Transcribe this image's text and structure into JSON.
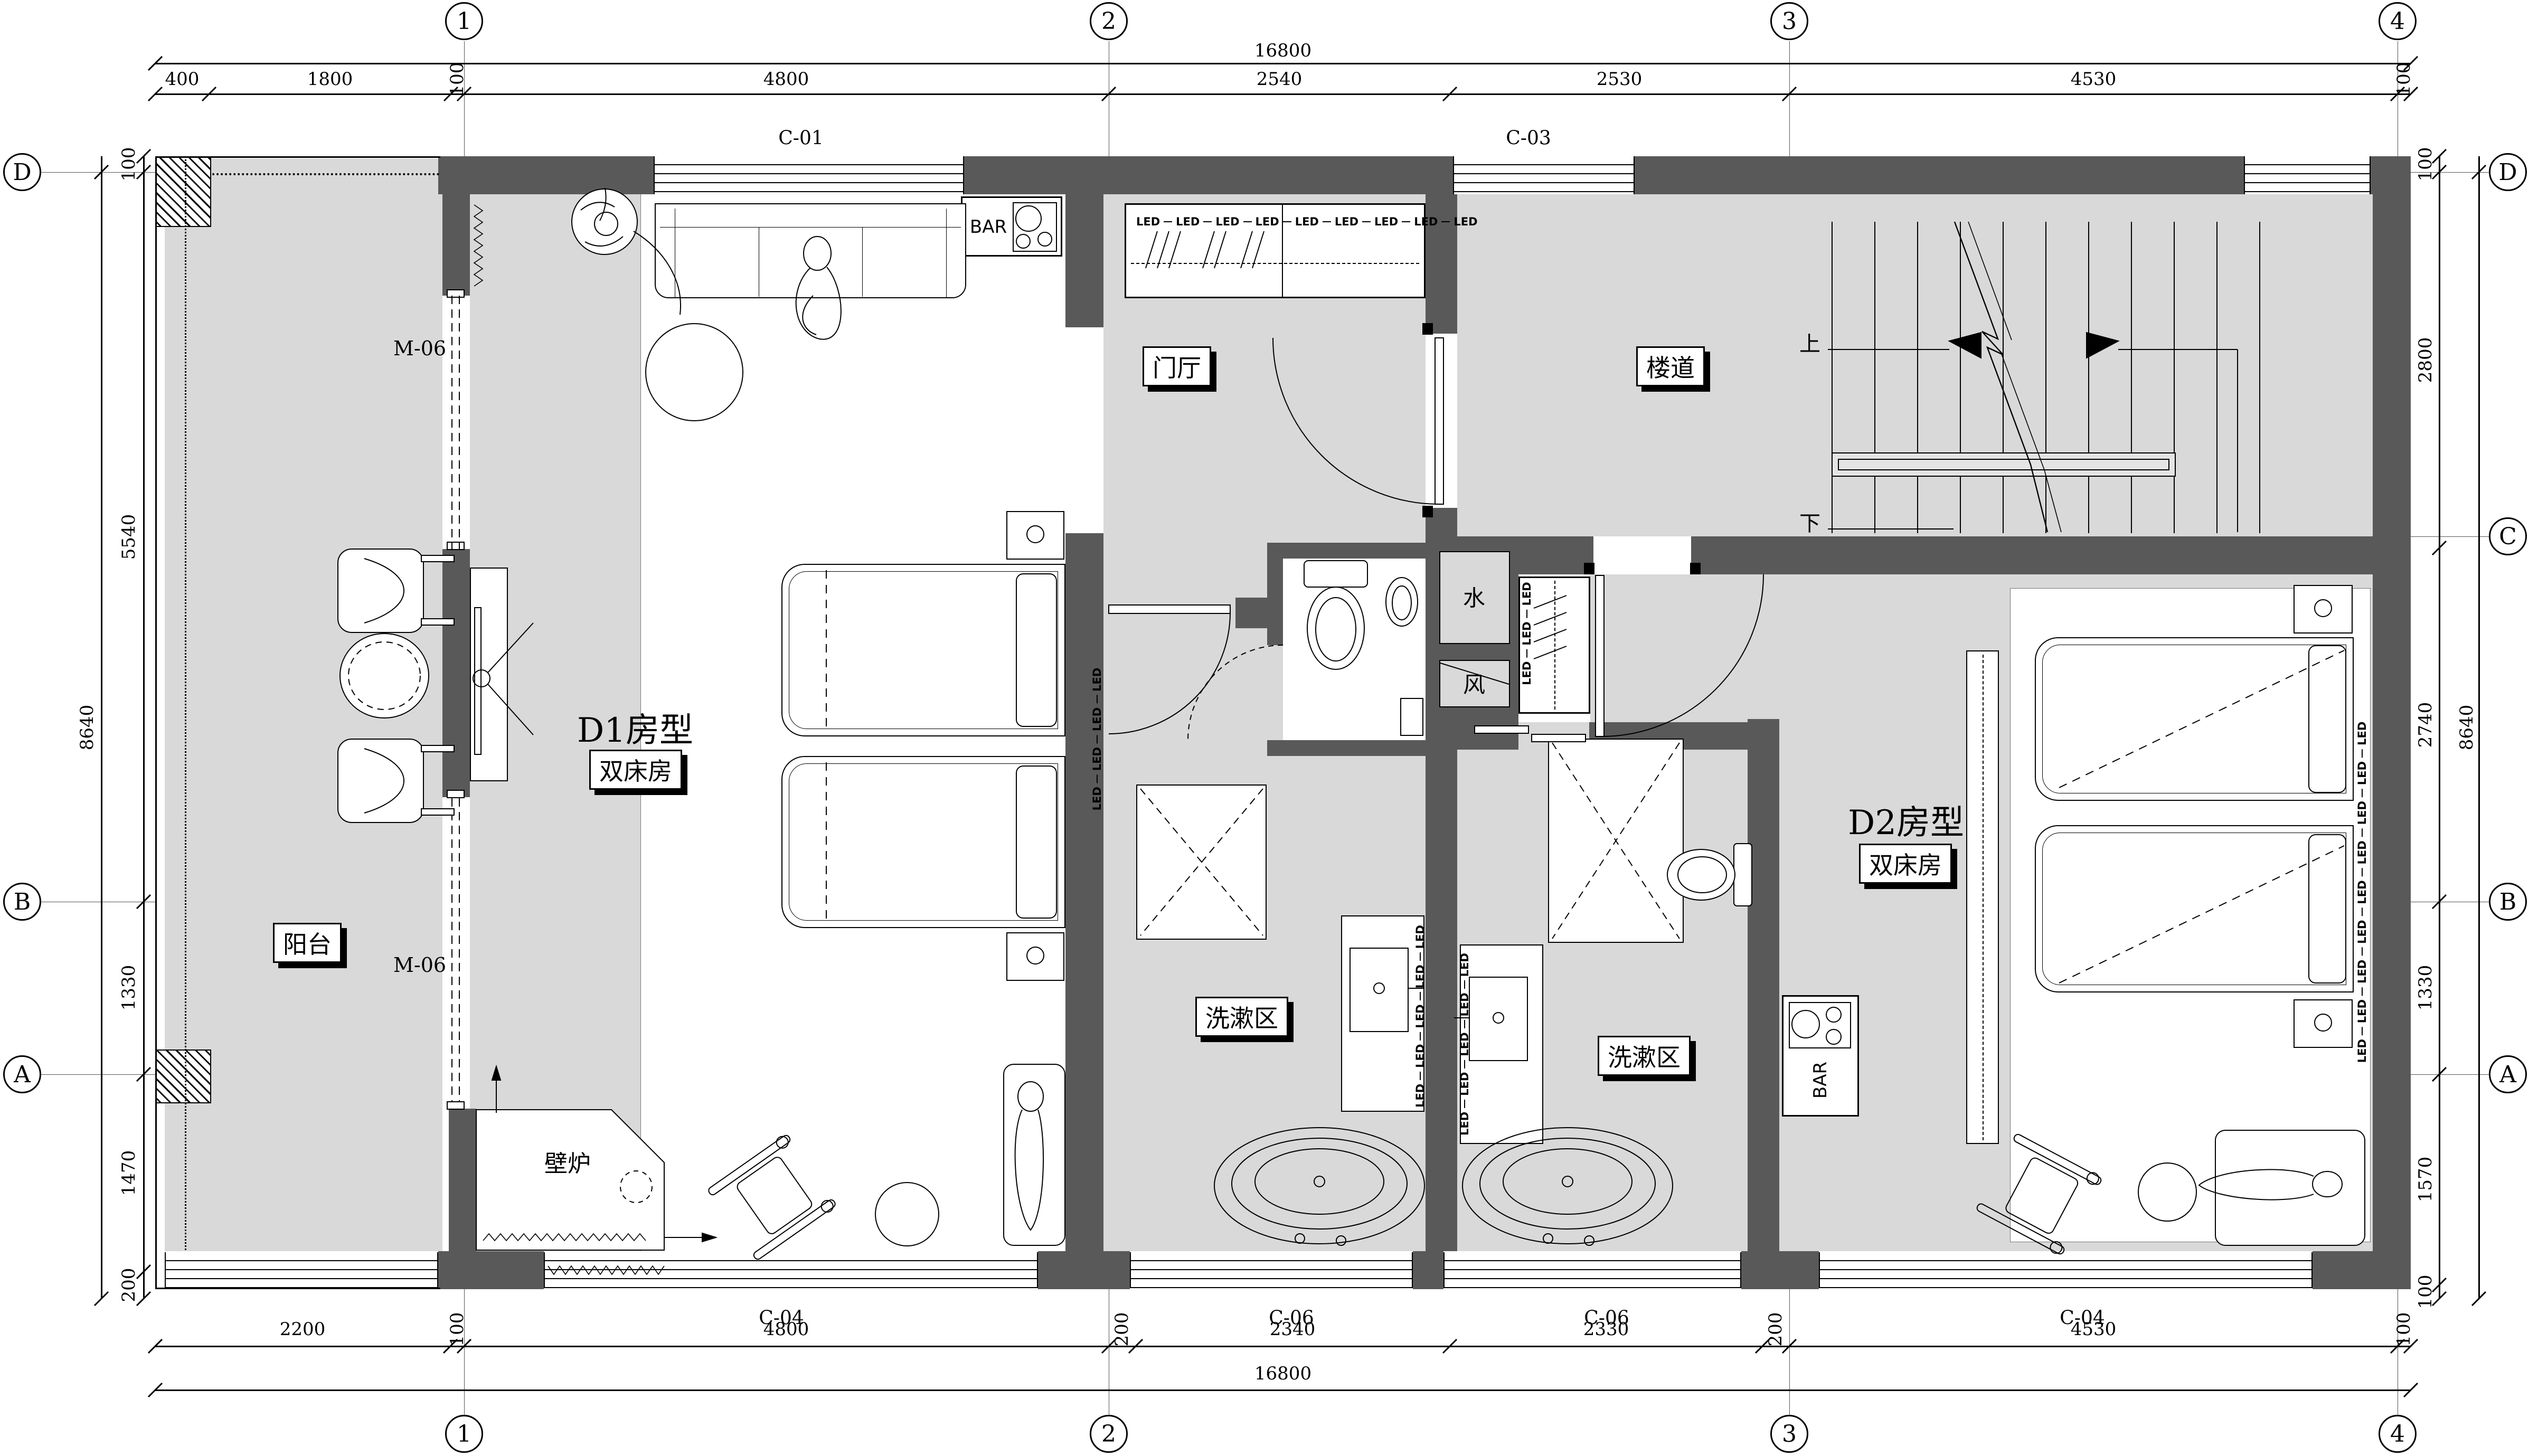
{
  "drawing": {
    "grid_top": [
      "1",
      "2",
      "3",
      "4"
    ],
    "grid_bottom": [
      "1",
      "2",
      "3",
      "4"
    ],
    "grid_left": [
      "D",
      "B",
      "A"
    ],
    "grid_right": [
      "D",
      "C",
      "B",
      "A"
    ],
    "dims": {
      "top_total": "16800",
      "top": [
        "400",
        "1800",
        "100",
        "4800",
        "2540",
        "2530",
        "4530",
        "100"
      ],
      "bottom": [
        "2200",
        "100",
        "4800",
        "200",
        "2340",
        "2330",
        "200",
        "4530",
        "100"
      ],
      "bottom_total": "16800",
      "left": [
        "100",
        "5540",
        "1330",
        "1470",
        "200"
      ],
      "left_total": "8640",
      "right": [
        "100",
        "2800",
        "2740",
        "1330",
        "1570",
        "100"
      ],
      "right_total": "8640"
    },
    "windows": {
      "c01": "C-01",
      "c03": "C-03",
      "c04_left": "C-04",
      "c06_left": "C-06",
      "c06_right": "C-06",
      "c04_right": "C-04"
    },
    "doors": {
      "m06_upper": "M-06",
      "m06_lower": "M-06"
    },
    "rooms": {
      "d1_name": "D1房型",
      "d1_type": "双床房",
      "d2_name": "D2房型",
      "d2_type": "双床房",
      "balcony": "阳台",
      "foyer": "门厅",
      "stair_hall": "楼道",
      "wash_d1": "洗漱区",
      "wash_d2": "洗漱区",
      "fireplace": "壁炉",
      "shaft_water": "水",
      "shaft_air": "风",
      "stair_up": "上",
      "stair_down": "下"
    },
    "fixtures": {
      "bar_d1": "BAR",
      "bar_d2": "BAR",
      "led": "LED"
    },
    "colors": {
      "wall": "#595959",
      "floor": "#d9d9d9",
      "line": "#000000"
    }
  }
}
